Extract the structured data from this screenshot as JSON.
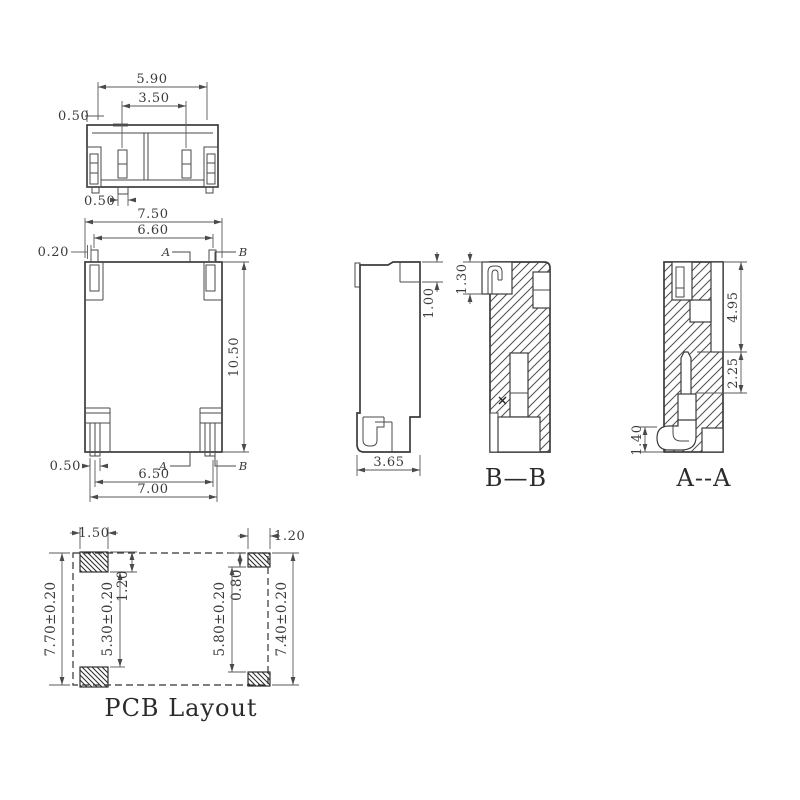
{
  "drawing": {
    "top_view": {
      "dim_width": "5.90",
      "dim_inner_width": "3.50",
      "dim_side_offset": "0.50",
      "dim_tab_width": "0.50"
    },
    "front_view": {
      "dim_outer_width": "7.50",
      "dim_inner_width": "6.60",
      "dim_pin_offset": "0.20",
      "dim_height": "10.50",
      "dim_pin_width": "0.50",
      "dim_pin_span": "6.50",
      "dim_foot_span": "7.00",
      "section_a_top": "A",
      "section_b_top": "B",
      "section_a_bottom": "A",
      "section_b_bottom": "B"
    },
    "side_view": {
      "dim_step_height": "1.00",
      "dim_depth": "3.65"
    },
    "section_bb": {
      "label": "B—B",
      "dim_latch_height": "1.30"
    },
    "section_aa": {
      "label": "A--A",
      "dim_upper_depth": "4.95",
      "dim_pin_depth": "2.25",
      "dim_foot_height": "1.40"
    },
    "pcb_layout": {
      "title": "PCB Layout",
      "dim_pad_width_left": "1.50",
      "dim_pad_width_right": "1.20",
      "dim_outer_height_left": "7.70±0.20",
      "dim_inner_height_left": "5.30±0.20",
      "dim_pad_height_left": "1.20",
      "dim_pad_height_right": "0.80",
      "dim_inner_height_right": "5.80±0.20",
      "dim_outer_height_right": "7.40±0.20"
    }
  }
}
